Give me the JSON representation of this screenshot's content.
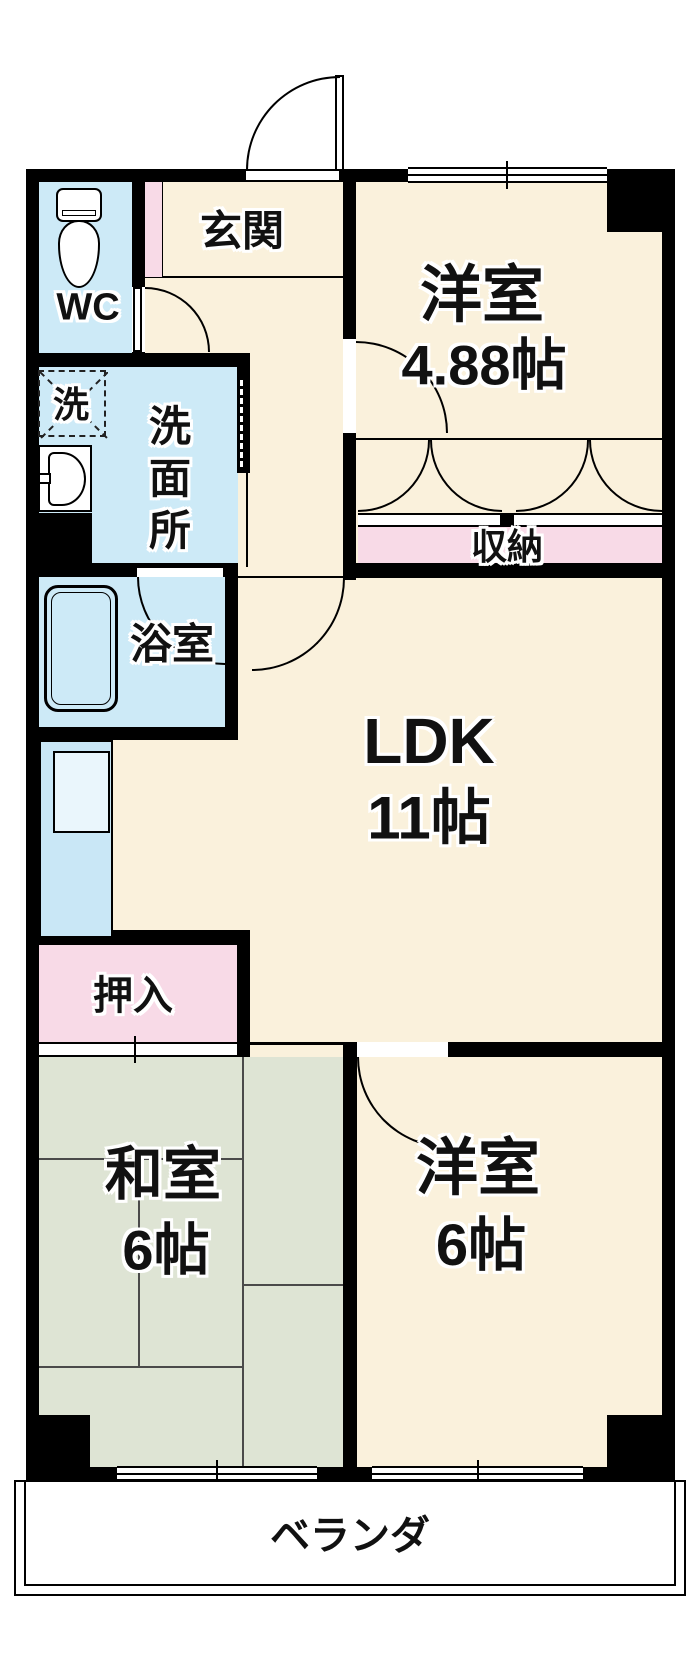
{
  "plan": {
    "colors": {
      "cream": "#FAF1DC",
      "blue": "#CDEAF7",
      "kitchen": "#C9E7F6",
      "sinkfill": "#EAF6FC",
      "pink": "#F8DAE7",
      "tatami": "#DEE4D4",
      "tatamiline": "#4a4a4a",
      "wall": "#000000",
      "ink": "#111111"
    },
    "rooms": {
      "genkan": {
        "label": "玄関"
      },
      "wc": {
        "label": "WC"
      },
      "laundry": {
        "label": "洗"
      },
      "washroom": {
        "chars": [
          "洗",
          "面",
          "所"
        ]
      },
      "bath": {
        "label": "浴室"
      },
      "western1": {
        "label": "洋室",
        "size": "4.88帖"
      },
      "storage": {
        "label": "収納"
      },
      "ldk": {
        "label": "LDK",
        "size": "11帖"
      },
      "oshiire": {
        "label": "押入"
      },
      "washitsu": {
        "label": "和室",
        "size": "6帖"
      },
      "western2": {
        "label": "洋室",
        "size": "6帖"
      },
      "veranda": {
        "label": "ベランダ"
      }
    }
  }
}
